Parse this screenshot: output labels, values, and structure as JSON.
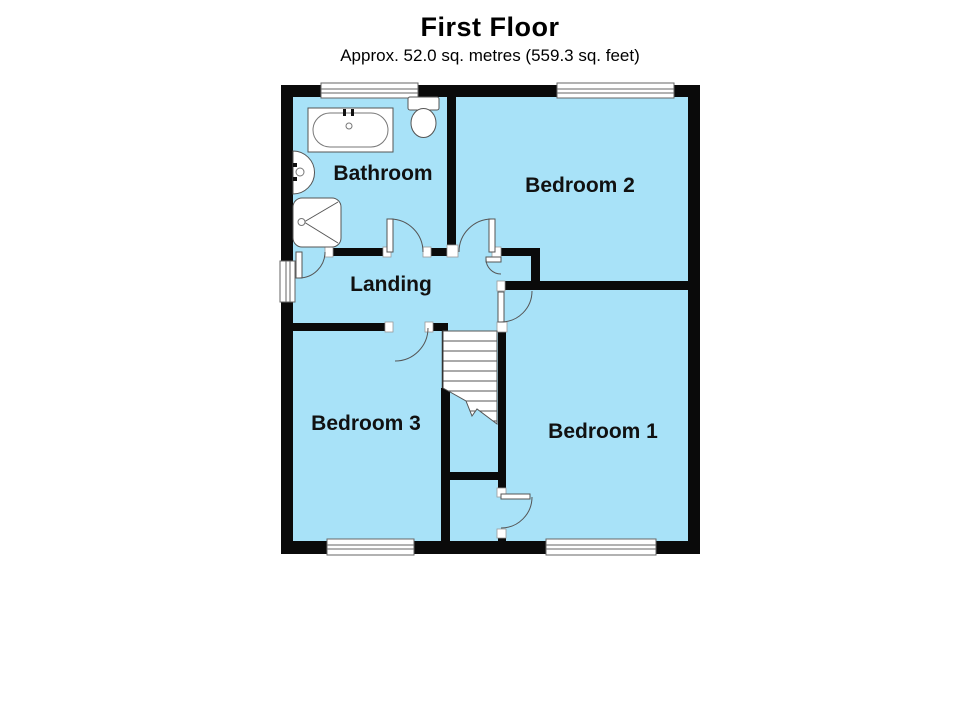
{
  "header": {
    "title": "First Floor",
    "subtitle": "Approx. 52.0 sq. metres (559.3 sq. feet)"
  },
  "rooms": {
    "bathroom": {
      "label": "Bathroom"
    },
    "bedroom2": {
      "label": "Bedroom 2"
    },
    "landing": {
      "label": "Landing"
    },
    "bedroom3": {
      "label": "Bedroom 3"
    },
    "bedroom1": {
      "label": "Bedroom 1"
    }
  },
  "fixtures": [
    "bathtub",
    "toilet",
    "sink",
    "shower",
    "staircase"
  ],
  "colors": {
    "room_fill": "#A8E2F8",
    "wall": "#0A0A0A",
    "background": "#FFFFFF",
    "outline": "#555555"
  }
}
